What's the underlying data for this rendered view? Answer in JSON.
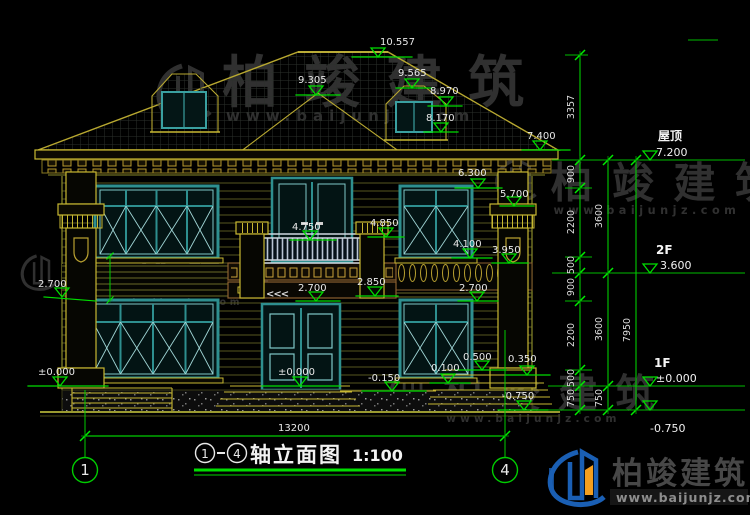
{
  "title": {
    "axis_from": "1",
    "axis_to": "4",
    "text": "轴立面图",
    "scale": "1:100"
  },
  "bubbles": {
    "left": "1",
    "right": "4"
  },
  "labels": {
    "ridge": "10.557",
    "dormer_ridge": "9.565",
    "hip_apex": "9.305",
    "dormer_eave": "8.970",
    "dormer_sill": "8.170",
    "eave": "7.400",
    "win2_top": "6.300",
    "pier_cap": "5.700",
    "rail_top": "4.750",
    "rail_top_right": "4.850",
    "win2_sill": "4.100",
    "emblem": "3.950",
    "ledge_left": "2.700",
    "band_center": "2.700",
    "band_right_pier": "2.850",
    "win1_top": "2.700",
    "porch_a": "0.500",
    "porch_b": "0.350",
    "porch_c": "0.100",
    "floor_zero": "±0.000",
    "terrace": "-0.150",
    "porch_ground": "-0.750",
    "left_zero": "±0.000"
  },
  "levels_right": {
    "roof_label": "屋顶",
    "roof_value": "7.200",
    "f2_label": "2F",
    "f2_value": "3.600",
    "f1_label": "1F",
    "f1_value": "±0.000",
    "ground_value": "-0.750"
  },
  "dims": {
    "right_chain_inner": [
      "3357",
      "900",
      "2200",
      "500",
      "900",
      "2200",
      "500",
      "750"
    ],
    "right_chain_mid": [
      "3600",
      "3600",
      "750"
    ],
    "right_chain_outer": [
      "7950"
    ],
    "bottom_width": "13200"
  },
  "symbols": {
    "slope_marks": "<<<"
  },
  "watermark": {
    "name": "柏竣建筑",
    "url": "www.baijunjz.com"
  },
  "brand": {
    "name": "柏竣建筑",
    "url": "www.baijunjz.com"
  },
  "colors": {
    "background": "#000000",
    "dimension_green": "#00cc00",
    "wall_yellow": "#c8b832",
    "siding_olive": "#5f5f22",
    "window_teal": "#2e8f8f",
    "band_brown": "#8a5f2a",
    "text_white": "#e8e8e8",
    "brand_blue": "#1a5fb4",
    "brand_orange": "#f59f1e"
  }
}
